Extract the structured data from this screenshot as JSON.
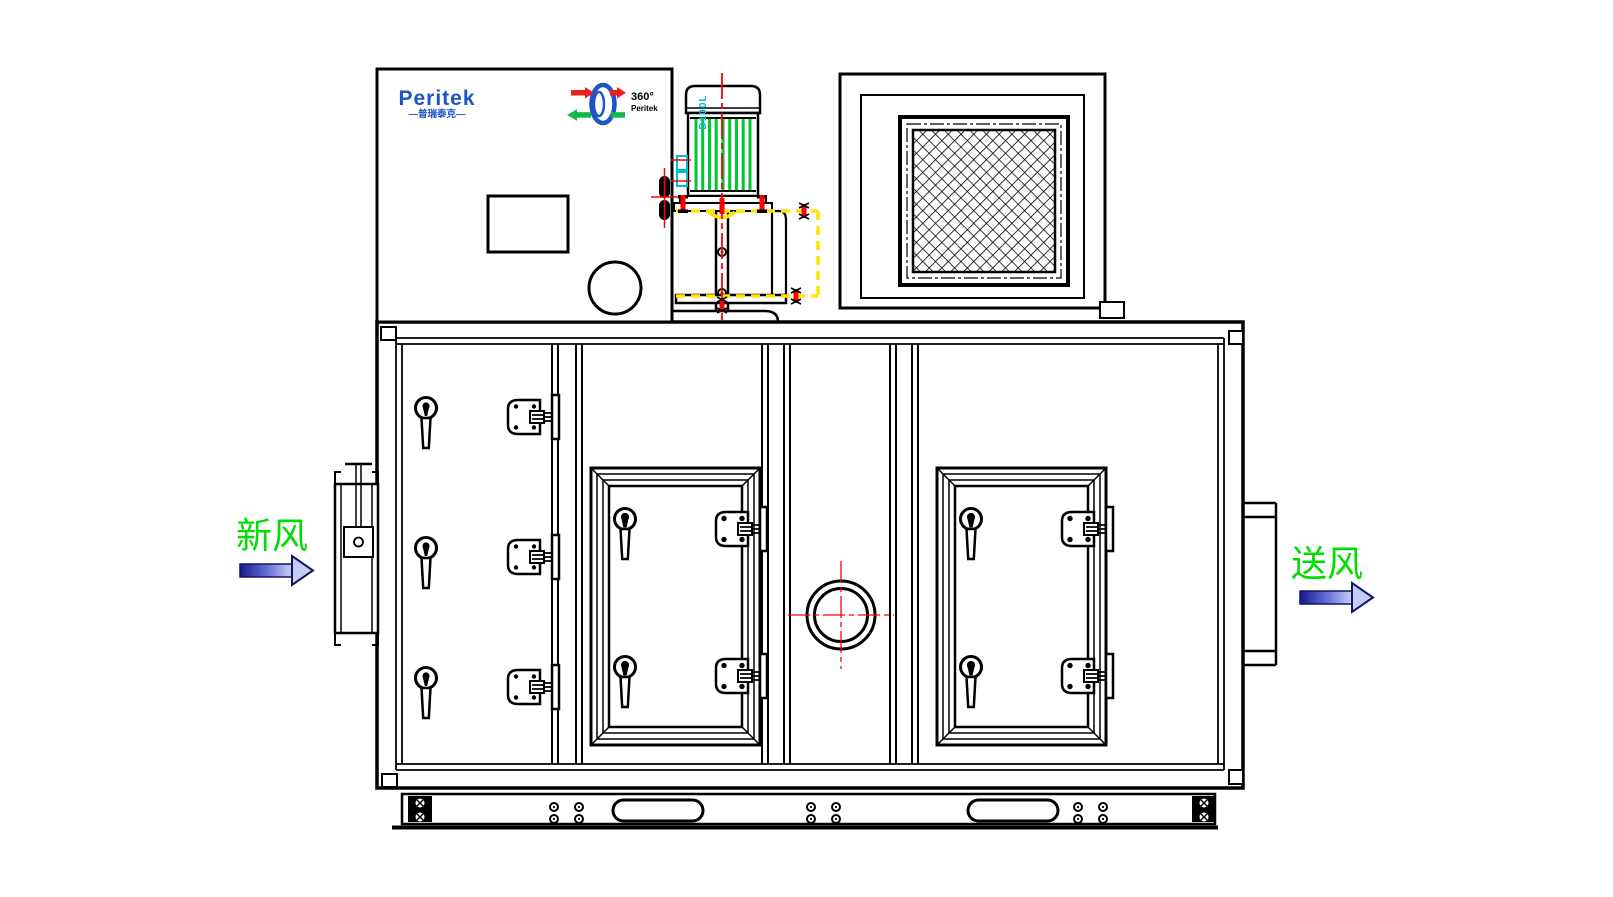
{
  "labels": {
    "fresh_air": "新风",
    "supply_air": "送风"
  },
  "brand": {
    "logo_text": "Peritek",
    "logo_subtext": "—普瑞泰克—",
    "wheel_text_top": "360°",
    "wheel_text_bottom": "Peritek"
  },
  "motor": {
    "frame_size_label": "D100L"
  },
  "colors": {
    "line_black": "#000000",
    "centerline_red": "#ff0000",
    "motor_fin_green": "#00c832",
    "dimension_yellow": "#ffe400",
    "label_green": "#00dd00",
    "brand_blue": "#1d55c4",
    "detail_cyan": "#00bcd4",
    "arrow_dark": "#181890",
    "arrow_light": "#c8d0fa"
  }
}
